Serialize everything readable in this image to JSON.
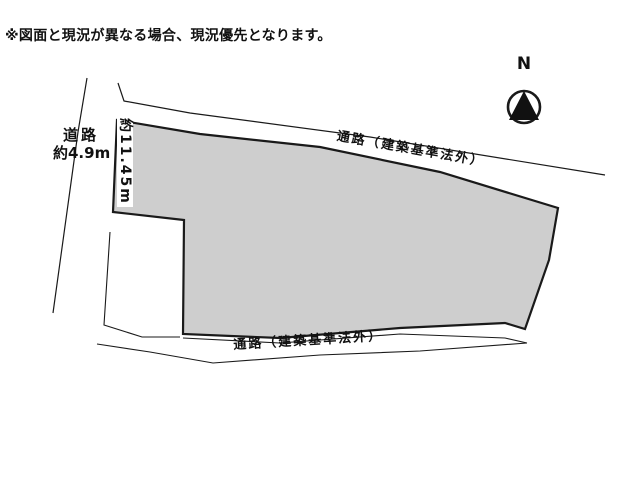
{
  "disclaimer": {
    "text": "※図面と現況が異なる場合、現況優先となります。"
  },
  "compass": {
    "label": "N"
  },
  "plot": {
    "left_road": {
      "name": "道路",
      "width": "約4.9m"
    },
    "west_edge_length": "約11.45m",
    "north_passage_label": "通路（建築基準法外）",
    "south_passage_label": "通路（建築基準法外）",
    "colors": {
      "parcel_fill": "#cecece",
      "line": "#1a1a1a"
    }
  }
}
